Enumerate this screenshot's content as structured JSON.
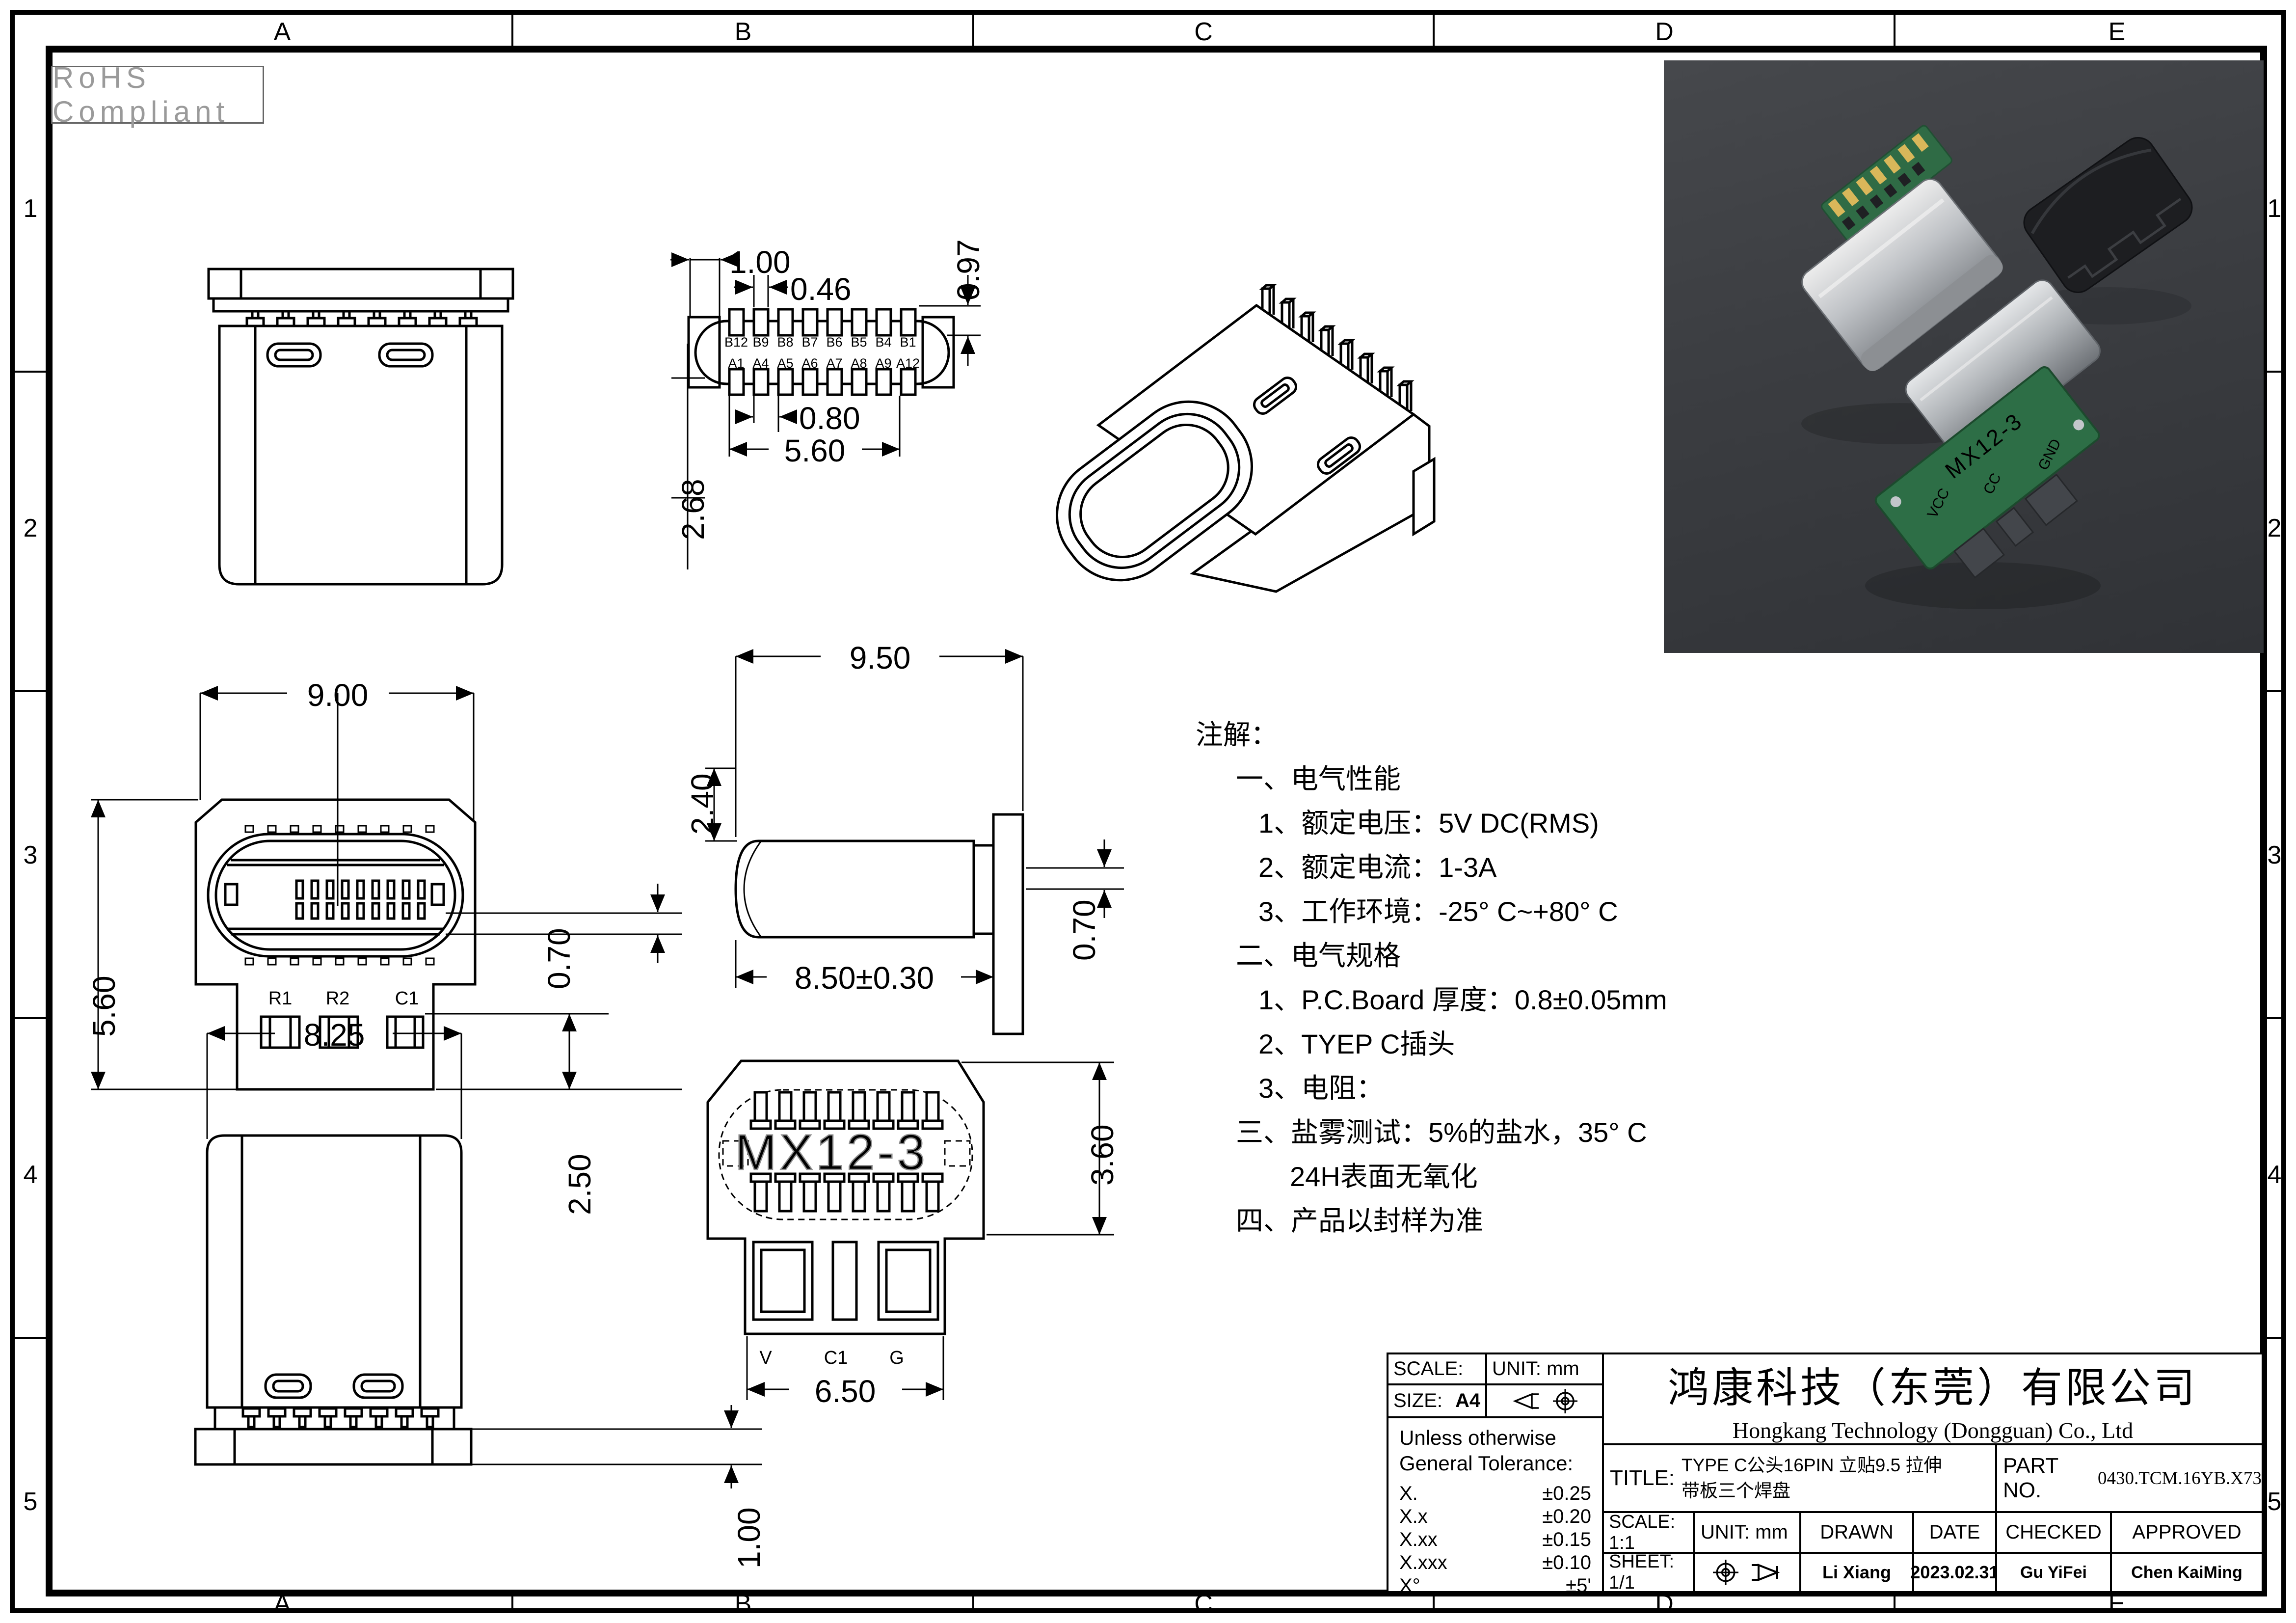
{
  "page": {
    "rohs": "RoHS Compliant"
  },
  "zones": {
    "top": [
      "A",
      "B",
      "C",
      "D",
      "E"
    ],
    "bottom": [
      "A",
      "B",
      "C",
      "D",
      "E"
    ],
    "left": [
      "1",
      "2",
      "3",
      "4",
      "5"
    ],
    "right": [
      "1",
      "2",
      "3",
      "4",
      "5"
    ]
  },
  "notes": {
    "lines": [
      "注解：",
      "一、电气性能",
      "1、额定电压：5V DC(RMS)",
      "2、额定电流：1-3A",
      "3、工作环境：-25° C~+80° C",
      "二、电气规格",
      "1、P.C.Board 厚度：0.8±0.05mm",
      "2、TYEP C插头",
      "3、电阻：",
      "三、盐雾测试：5%的盐水，35° C",
      "24H表面无氧化",
      "四、产品以封样为准"
    ]
  },
  "views": {
    "pad_layout": {
      "dims": {
        "d100": "1.00",
        "d046": "0.46",
        "d097": "0.97",
        "d080": "0.80",
        "d560": "5.60",
        "d268": "2.68"
      },
      "pins_top": [
        "B12",
        "B9",
        "B8",
        "B7",
        "B6",
        "B5",
        "B4",
        "B1"
      ],
      "pins_bottom": [
        "A1",
        "A4",
        "A5",
        "A6",
        "A7",
        "A8",
        "A9",
        "A12"
      ]
    },
    "mating_face": {
      "dims": {
        "d900": "9.00",
        "d560": "5.60",
        "d070": "0.70",
        "d250": "2.50"
      },
      "components": [
        "R1",
        "R2",
        "C1"
      ]
    },
    "side": {
      "dims": {
        "d950": "9.50",
        "d240": "2.40",
        "d850": "8.50±0.30",
        "d070": "0.70"
      }
    },
    "back": {
      "dims": {
        "d825": "8.25",
        "d100": "1.00"
      }
    },
    "bottom": {
      "dims": {
        "d360": "3.60",
        "d650": "6.50"
      },
      "ghost": "MX12-3",
      "pads": [
        "V",
        "C1",
        "G"
      ]
    }
  },
  "photo": {
    "board_text": "MX12-3",
    "label_vcc": "VCC",
    "label_cc": "CC",
    "label_gnd": "GND"
  },
  "title_block": {
    "scale_label": "SCALE:",
    "unit_top": "UNIT: mm",
    "size_label": "SIZE:",
    "size_value": "A4",
    "tol_header1": "Unless otherwise",
    "tol_header2": "General Tolerance:",
    "tolerances": [
      {
        "k": "X.",
        "v": "±0.25"
      },
      {
        "k": "X.x",
        "v": "±0.20"
      },
      {
        "k": "X.xx",
        "v": "±0.15"
      },
      {
        "k": "X.xxx",
        "v": "±0.10"
      },
      {
        "k": "X°",
        "v": "±5'"
      }
    ],
    "company_cn": "鸿康科技（东莞）有限公司",
    "company_en": "Hongkang Technology (Dongguan) Co., Ltd",
    "title_label": "TITLE:",
    "title_line1": "TYPE C公头16PIN 立贴9.5 拉伸",
    "title_line2": "带板三个焊盘",
    "part_label": "PART NO.",
    "part_no": "0430.TCM.16YB.X73",
    "scale_value": "SCALE: 1:1",
    "unit_value": "UNIT: mm",
    "drawn_label": "DRAWN",
    "date_label": "DATE",
    "checked_label": "CHECKED",
    "approved_label": "APPROVED",
    "sheet_value": "SHEET: 1/1",
    "drawn_by": "Li Xiang",
    "date_value": "2023.02.31",
    "checked_by": "Gu YiFei",
    "approved_by": "Chen KaiMing"
  }
}
